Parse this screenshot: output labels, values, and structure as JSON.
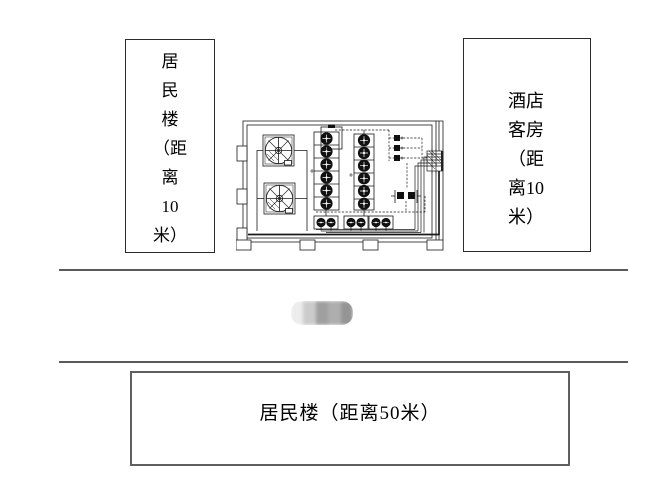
{
  "window": {
    "width": 663,
    "height": 495,
    "background": "#ffffff"
  },
  "labels": {
    "left_building": {
      "full_text": "居民楼（距离10米）",
      "lines": [
        "居",
        "民",
        "楼",
        "（距",
        "离",
        "10",
        "米）"
      ]
    },
    "hotel_rooms": {
      "full_text": "酒店客房（距离10米）",
      "lines": [
        "酒店",
        "客房",
        "（距",
        "离10",
        "米）"
      ]
    },
    "bottom_building": {
      "text": "居民楼（距离50米）"
    }
  },
  "diagram": {
    "name": "equipment-room-floor-plan",
    "components": {
      "fans": 2,
      "tank_columns": 2,
      "tanks_per_column": 6,
      "pump_pairs": 3,
      "valves": 3,
      "wall_connector": 1
    }
  },
  "redaction": {
    "cells": [
      "#ececec",
      "#cbcbcb",
      "#9f9f9f",
      "#aeaeae",
      "#959595"
    ]
  },
  "colors": {
    "line": "#1a1a1a",
    "divider": "#5a5a5a",
    "box_border": "#2b2b2b"
  }
}
